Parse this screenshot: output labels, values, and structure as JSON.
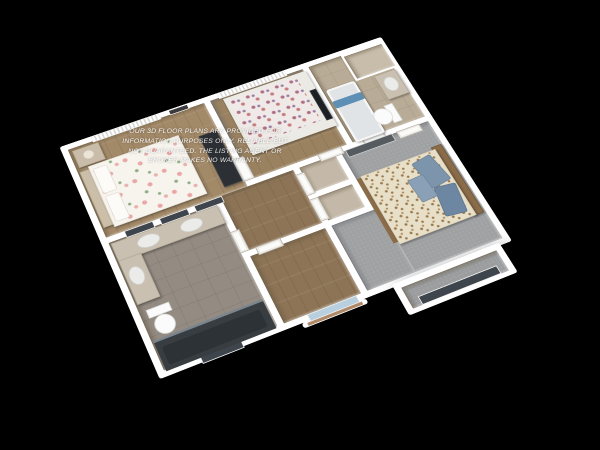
{
  "watermark": {
    "lines": [
      "OUR 3D FLOOR PLANS ARE PROVIDED FOR",
      "INFORMATION PURPOSES ONLY. RELIABLE BUT",
      "NOT GUARANTEED. THE LISTING AGENT OR",
      "BROKER MAKES NO WARRANTY."
    ]
  },
  "canvas": {
    "background": "#000000",
    "building_wall_color": "#ffffff"
  },
  "rooms": {
    "master_bedroom": {
      "floor": "#a28968"
    },
    "bedroom_2": {
      "floor": "#9a8261"
    },
    "bathroom_2": {
      "floor": "#b9ac97"
    },
    "closet_top_right": {
      "floor": "#c8bdab"
    },
    "hallway": {
      "floor": "#8d7456"
    },
    "den": {
      "floor": "#8d7456"
    },
    "closet_a": {
      "floor": "#c4b9a8"
    },
    "closet_b": {
      "floor": "#c4b9a8"
    },
    "bedroom_3": {
      "floor": "#9fa1a3"
    },
    "bathroom_1": {
      "floor": "#948c83"
    },
    "bay_nook": {
      "floor": "#9b9d9f"
    }
  },
  "furniture": {
    "master_bed": "#f7f4ee",
    "master_headboard": "#cbbfa9",
    "nightstand": "#c9bda9",
    "lamp": "#ece5d7",
    "wardrobe": "#2c2f33",
    "bed2_mattress": "#efe9e7",
    "bed2_frame": "#eceae4",
    "tv": "#1d2023",
    "bed3_mattress": "#e8dfc8",
    "bed3_headboard": "#8a6c49",
    "pillow_blue_1": "#7d94ad",
    "pillow_blue_2": "#6d86a1",
    "pillow_blue_3": "#8aa0b6",
    "tub": "#f1f1f1",
    "tub_inner": "#e0e4e6",
    "towel": "#5e8fb5",
    "toilet": "#fbfbfb",
    "vanity": "#c9c0b2",
    "sink": "#ebebe9",
    "shower": "#383d42",
    "shower_inner": "#2d3237",
    "picture_frame": "#3b3b3b",
    "window_dark": "#3f454c",
    "window_light": "#b7cfdf",
    "window_sill": "#b08968",
    "mirror_closet": "#565b60"
  }
}
